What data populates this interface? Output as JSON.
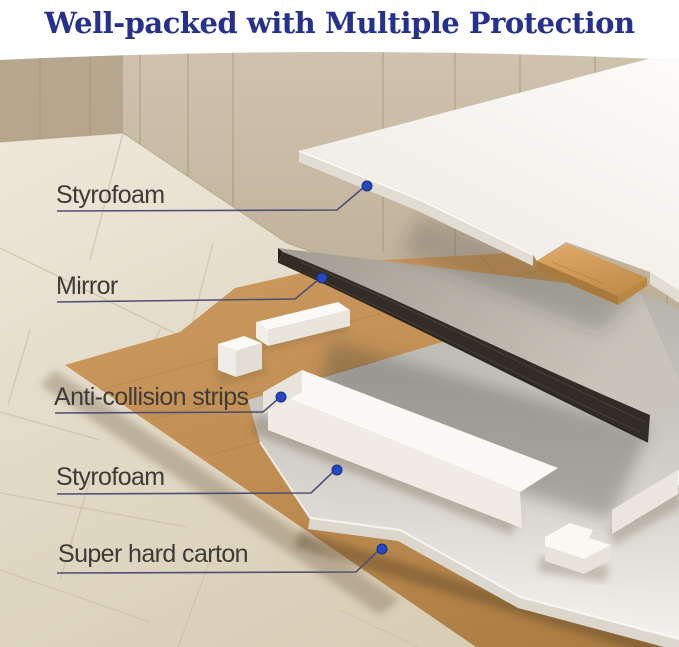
{
  "title": "Well-packed with Multiple Protection",
  "labels": [
    {
      "id": "styrofoam-top",
      "text": "Styrofoam"
    },
    {
      "id": "mirror",
      "text": "Mirror"
    },
    {
      "id": "anti-collision-strips",
      "text": "Anti-collision strips"
    },
    {
      "id": "styrofoam-bottom",
      "text": "Styrofoam"
    },
    {
      "id": "super-hard-carton",
      "text": "Super hard carton"
    }
  ],
  "colors": {
    "title_text": "#25308f",
    "label_text": "#3e3b37",
    "leader_line": "#4e4f74",
    "callout_dot": "#2547c0",
    "wall_tile": "#c6b8a2",
    "floor_tile": "#e3dbc9",
    "carton_tan": "#c08d53",
    "foam_white": "#f7f5f0",
    "mirror_frame": "#322c26",
    "mirror_glass": "#b3afa6",
    "cardboard_pad": "#d8a462"
  }
}
